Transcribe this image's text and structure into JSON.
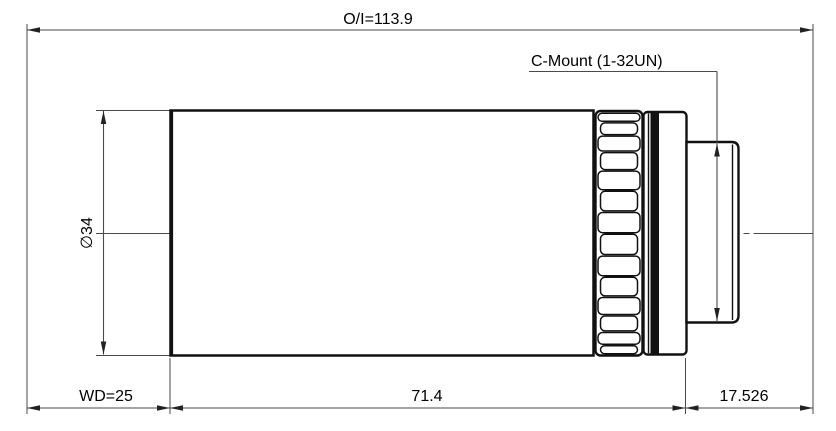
{
  "drawing": {
    "kind": "lens-dimension-drawing",
    "labels": {
      "overall": "O/I=113.9",
      "mount": "C-Mount (1-32UN)",
      "diameter": "∅34",
      "working_distance": "WD=25",
      "body_length": "71.4",
      "flange_distance": "17.526"
    },
    "values": {
      "overall_mm": 113.9,
      "working_distance_mm": 25,
      "body_length_mm": 71.4,
      "flange_distance_mm": 17.526,
      "diameter_mm": 34,
      "mount_thread": "1-32UN"
    },
    "colors": {
      "background": "#ffffff",
      "part_outline": "#111111",
      "dimension_lines": "#4a4a4a",
      "text": "#000000"
    }
  }
}
